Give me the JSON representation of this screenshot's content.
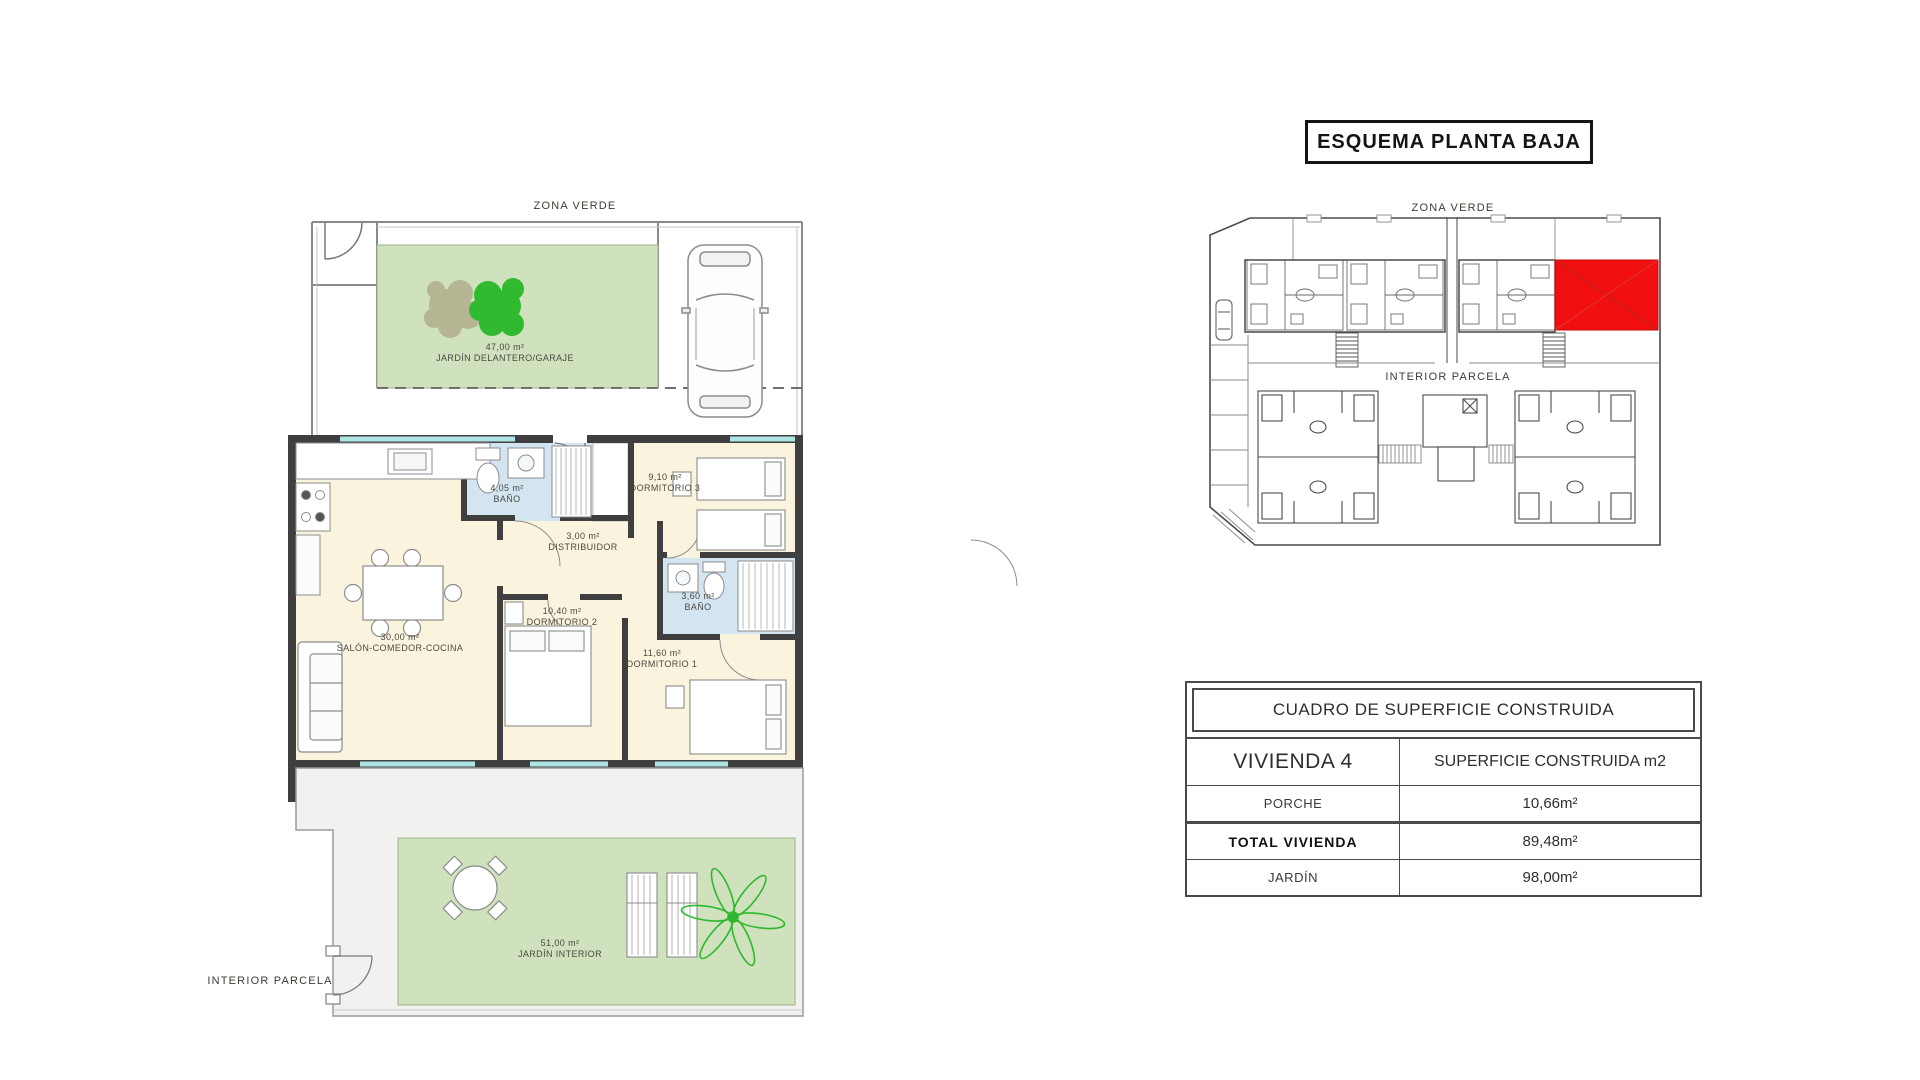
{
  "floor_plan": {
    "zona_verde": "ZONA VERDE",
    "interior_parcela": "INTERIOR PARCELA",
    "front_garden": {
      "area": "47,00 m²",
      "name": "JARDÍN DELANTERO/GARAJE"
    },
    "salon": {
      "area": "30,00 m²",
      "name": "SALÓN-COMEDOR-COCINA"
    },
    "bano_1": {
      "area": "4,05 m²",
      "name": "BAÑO"
    },
    "distribuidor": {
      "area": "3,00 m²",
      "name": "DISTRIBUIDOR"
    },
    "dormitorio_3": {
      "area": "9,10 m²",
      "name": "DORMITORIO 3"
    },
    "dormitorio_2": {
      "area": "10,40 m²",
      "name": "DORMITORIO 2"
    },
    "dormitorio_1": {
      "area": "11,60 m²",
      "name": "DORMITORIO 1"
    },
    "bano_2": {
      "area": "3,60 m²",
      "name": "BAÑO"
    },
    "interior_garden": {
      "area": "51,00 m²",
      "name": "JARDÍN INTERIOR"
    }
  },
  "site_plan": {
    "title": "ESQUEMA PLANTA BAJA",
    "zona_verde": "ZONA VERDE",
    "interior_parcela": "INTERIOR PARCELA"
  },
  "surface_table": {
    "title": "CUADRO DE SUPERFICIE CONSTRUIDA",
    "col_unit": "VIVIENDA 4",
    "col_surface": "SUPERFICIE CONSTRUIDA m2",
    "rows": [
      {
        "label": "PORCHE",
        "value": "10,66m²"
      },
      {
        "label": "TOTAL VIVIENDA",
        "value": "89,48m²"
      },
      {
        "label": "JARDÍN",
        "value": "98,00m²"
      }
    ]
  },
  "colors": {
    "garden_green": "#cfe2bd",
    "floor_cream": "#faf3dd",
    "bath_blue": "#d4e5f2",
    "wall_dark": "#3f3f3f",
    "window_cyan": "#aee4e4",
    "terrace_grey": "#f1f1ef",
    "highlight_red": "#f20f0f",
    "tree_green": "#2fba2f",
    "tree_olive": "#b5b593"
  }
}
